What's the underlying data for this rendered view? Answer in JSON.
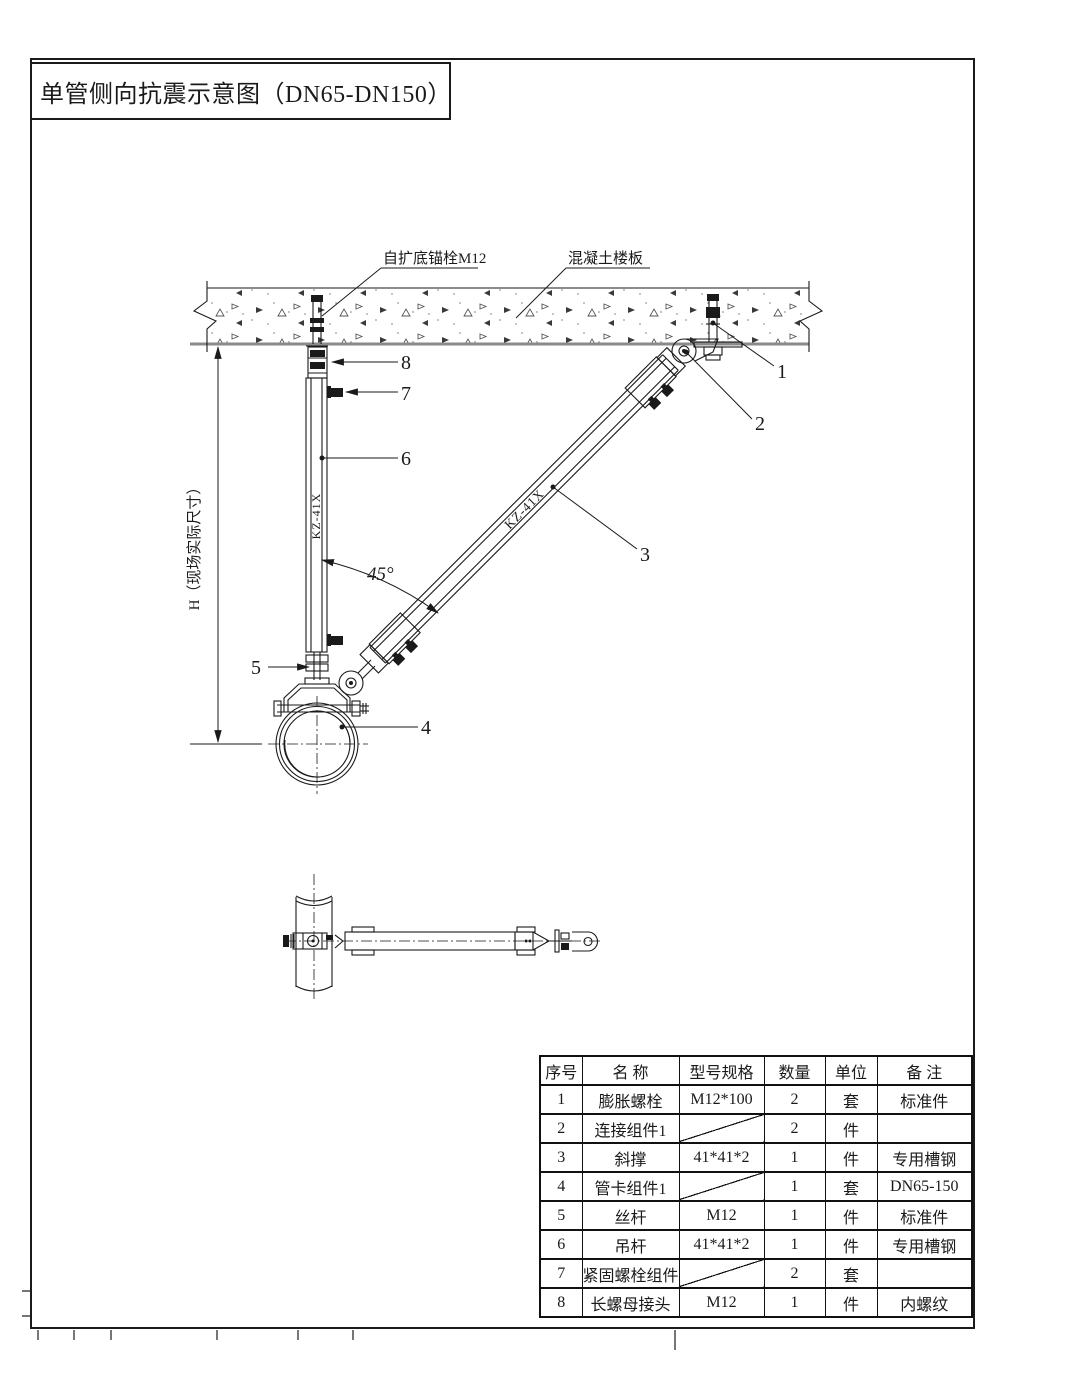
{
  "page": {
    "title": "单管侧向抗震示意图（DN65-DN150）"
  },
  "drawing": {
    "labels": {
      "anchor_bolt": "自扩底锚栓M12",
      "concrete_slab": "混凝土楼板",
      "height_dim": "H（现场实际尺寸）",
      "angle": "45°",
      "hanger_mark": "KZ-41X",
      "brace_mark": "KZ-41X"
    },
    "callouts": {
      "c1": "1",
      "c2": "2",
      "c3": "3",
      "c4": "4",
      "c5": "5",
      "c6": "6",
      "c7": "7",
      "c8": "8"
    }
  },
  "bom": {
    "headers": [
      "序号",
      "名 称",
      "型号规格",
      "数量",
      "单位",
      "备 注"
    ],
    "rows": [
      {
        "no": "1",
        "name": "膨胀螺栓",
        "spec": "M12*100",
        "qty": "2",
        "unit": "套",
        "note": "标准件"
      },
      {
        "no": "2",
        "name": "连接组件1",
        "spec": "",
        "qty": "2",
        "unit": "件",
        "note": ""
      },
      {
        "no": "3",
        "name": "斜撑",
        "spec": "41*41*2",
        "qty": "1",
        "unit": "件",
        "note": "专用槽钢"
      },
      {
        "no": "4",
        "name": "管卡组件1",
        "spec": "",
        "qty": "1",
        "unit": "套",
        "note": "DN65-150"
      },
      {
        "no": "5",
        "name": "丝杆",
        "spec": "M12",
        "qty": "1",
        "unit": "件",
        "note": "标准件"
      },
      {
        "no": "6",
        "name": "吊杆",
        "spec": "41*41*2",
        "qty": "1",
        "unit": "件",
        "note": "专用槽钢"
      },
      {
        "no": "7",
        "name": "紧固螺栓组件",
        "spec": "",
        "qty": "2",
        "unit": "套",
        "note": ""
      },
      {
        "no": "8",
        "name": "长螺母接头",
        "spec": "M12",
        "qty": "1",
        "unit": "件",
        "note": "内螺纹"
      }
    ]
  },
  "colors": {
    "line": "#1a1a1a",
    "slab_edge": "#8a8a8a",
    "background": "#ffffff"
  }
}
